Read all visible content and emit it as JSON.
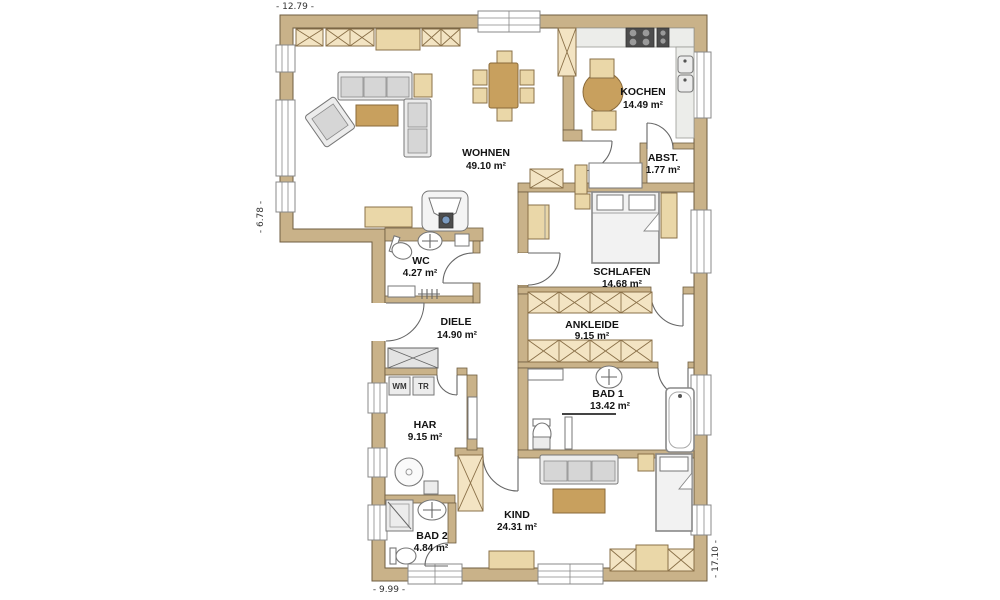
{
  "plan": {
    "type": "floor-plan",
    "dimensions": {
      "top": "- 12.79 -",
      "left": "- 6.78 -",
      "bottom": "- 9.99 -",
      "right": "- 17.10 -"
    },
    "rooms": {
      "wohnen": {
        "name": "WOHNEN",
        "area": "49.10 m²"
      },
      "kochen": {
        "name": "KOCHEN",
        "area": "14.49 m²"
      },
      "abst": {
        "name": "ABST.",
        "area": "1.77 m²"
      },
      "schlafen": {
        "name": "SCHLAFEN",
        "area": "14.68 m²"
      },
      "ankleide": {
        "name": "ANKLEIDE",
        "area": "9.15 m²"
      },
      "bad1": {
        "name": "BAD 1",
        "area": "13.42 m²"
      },
      "wc": {
        "name": "WC",
        "area": "4.27 m²"
      },
      "diele": {
        "name": "DIELE",
        "area": "14.90 m²"
      },
      "har": {
        "name": "HAR",
        "area": "9.15 m²"
      },
      "bad2": {
        "name": "BAD 2",
        "area": "4.84 m²"
      },
      "kind": {
        "name": "KIND",
        "area": "24.31 m²"
      }
    },
    "appliances": {
      "washer": "WM",
      "dryer": "TR"
    },
    "colors": {
      "wall": "#c9b289",
      "furniture": "#ead7a8",
      "wood": "#c8a05e",
      "hatch": "#f3e4c3",
      "counter": "#ecedea"
    }
  }
}
